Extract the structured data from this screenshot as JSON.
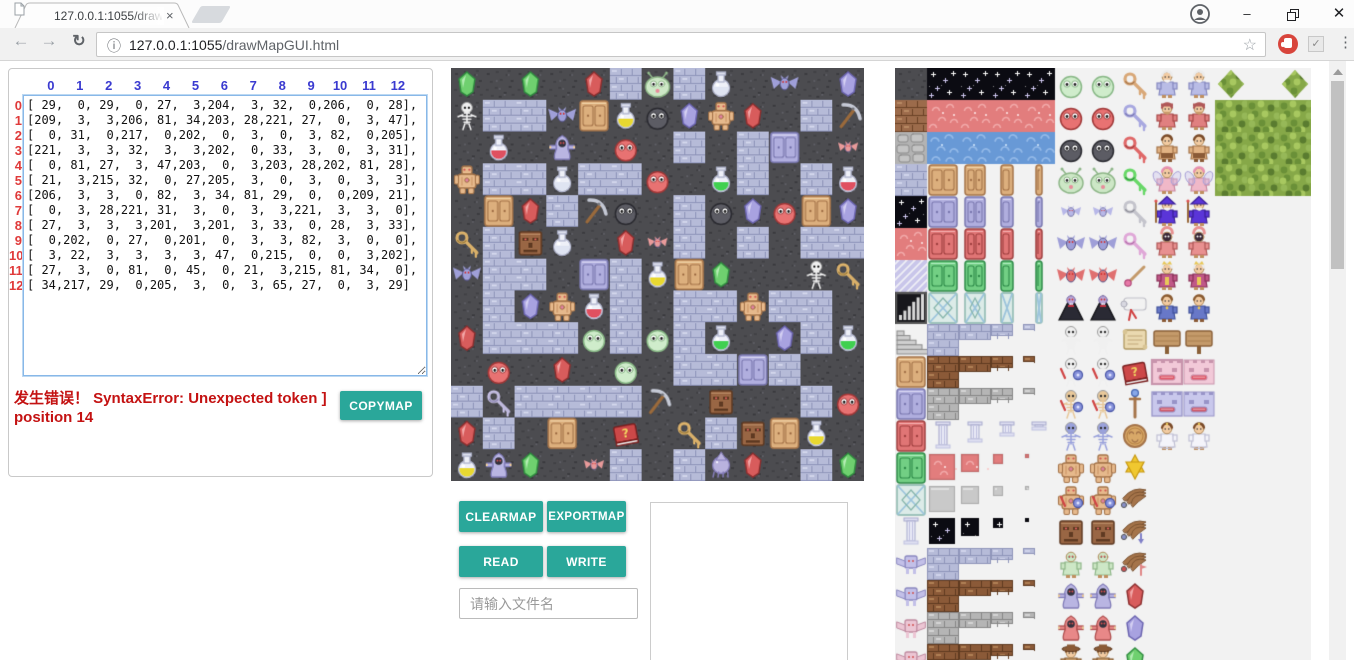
{
  "browser": {
    "tab_title": "127.0.0.1:1055/drawMa",
    "url_host": "127.0.0.1:1055",
    "url_path": "/drawMapGUI.html",
    "icons": {
      "back": "←",
      "forward": "→",
      "reload": "↻",
      "page_info": "ⓘ",
      "bookmark_star": "☆",
      "menu_dots": "⋮",
      "tab_close": "×",
      "window_minimize": "–",
      "window_close": "✕",
      "extension_check": "✓"
    }
  },
  "matrix_panel": {
    "col_headers": [
      "0",
      "1",
      "2",
      "3",
      "4",
      "5",
      "6",
      "7",
      "8",
      "9",
      "10",
      "11",
      "12"
    ],
    "row_headers": [
      "0",
      "1",
      "2",
      "3",
      "4",
      "5",
      "6",
      "7",
      "8",
      "9",
      "10",
      "11",
      "12"
    ],
    "rows": [
      [
        29,
        0,
        29,
        0,
        27,
        3,
        204,
        3,
        32,
        0,
        206,
        0,
        28
      ],
      [
        209,
        3,
        3,
        206,
        81,
        34,
        203,
        28,
        221,
        27,
        0,
        3,
        47
      ],
      [
        0,
        31,
        0,
        217,
        0,
        202,
        0,
        3,
        0,
        3,
        82,
        0,
        205
      ],
      [
        221,
        3,
        3,
        32,
        3,
        3,
        202,
        0,
        33,
        3,
        0,
        3,
        31
      ],
      [
        0,
        81,
        27,
        3,
        47,
        203,
        0,
        3,
        203,
        28,
        202,
        81,
        28
      ],
      [
        21,
        3,
        215,
        32,
        0,
        27,
        205,
        3,
        0,
        3,
        0,
        3,
        3
      ],
      [
        206,
        3,
        3,
        0,
        82,
        3,
        34,
        81,
        29,
        0,
        0,
        209,
        21
      ],
      [
        0,
        3,
        28,
        221,
        31,
        3,
        0,
        3,
        3,
        221,
        3,
        3,
        0
      ],
      [
        27,
        3,
        3,
        3,
        201,
        3,
        201,
        3,
        33,
        0,
        28,
        3,
        33
      ],
      [
        0,
        202,
        0,
        27,
        0,
        201,
        0,
        3,
        3,
        82,
        3,
        0,
        0
      ],
      [
        3,
        22,
        3,
        3,
        3,
        3,
        47,
        0,
        215,
        0,
        0,
        3,
        202
      ],
      [
        27,
        3,
        0,
        81,
        0,
        45,
        0,
        21,
        3,
        215,
        81,
        34,
        0
      ],
      [
        34,
        217,
        29,
        0,
        205,
        3,
        0,
        3,
        65,
        27,
        0,
        3,
        29
      ]
    ],
    "error": {
      "line1": "发生错误！ SyntaxError: Unexpected token ]",
      "line2": "position 14"
    },
    "copymap_label": "COPYMAP"
  },
  "map_editor": {
    "grid_size": "13x13",
    "tile_legend": {
      "0": "dark-stone-floor",
      "3": "blue-brick-floor",
      "21": "gold-key",
      "22": "silver-key",
      "27": "red-gem",
      "28": "purple-gem",
      "29": "green-gem",
      "31": "red-potion",
      "32": "empty-flask",
      "33": "green-potion",
      "34": "yellow-potion",
      "45": "question-book",
      "47": "pickaxe",
      "65": "purple-squid",
      "81": "tan-door",
      "82": "purple-door",
      "201": "pale-green-blob",
      "202": "red-blob",
      "203": "dark-blob",
      "204": "antenna-slime",
      "205": "pink-bat",
      "206": "purple-bat",
      "209": "skeleton",
      "215": "stone-face",
      "217": "ghost",
      "221": "golem"
    }
  },
  "controls": {
    "clearmap_label": "CLEARMAP",
    "exportmap_label": "EXPORTMAP",
    "read_label": "READ",
    "write_label": "WRITE",
    "filename_placeholder": "请输入文件名",
    "output_value": ""
  },
  "tileset_panel": {
    "legend": {
      "ds": "dark-stone-tile",
      "bb": "brown-brick-tile",
      "gs": "gray-stone-tile",
      "bl": "blue-brick-tile",
      "sf": "night-sky-tile",
      "rg": "red-ground-tile",
      "wt": "water-tile",
      "dg": "diagonal-stripes-tile",
      "br": "bar-graph-tile",
      "st": "stairs-tile",
      "td": "tan-door",
      "pd": "purple-door",
      "rd": "red-door",
      "gd": "green-door",
      "lt": "lattice-tile",
      "cm": "column-tile",
      "pt": "purple-altar",
      "kt": "pink-altar",
      "lB": "blue-brick-ledge",
      "lN": "dirt-ledge",
      "lG": "stone-ledge",
      "pR": "red-ground-piece",
      "pG": "stone-piece",
      "pS": "night-sky-piece",
      "mg": "green-blob-monster",
      "mr": "red-blob-monster",
      "mk": "dark-blob-monster",
      "ms": "antenna-slime",
      "b1": "pink-bat",
      "b2": "purple-bat",
      "b3": "red-bat",
      "vp": "vampire",
      "sk": "skeleton",
      "s2": "skeleton-with-shield",
      "s3": "tan-skeleton-with-shield",
      "s4": "armored-skeleton",
      "gl": "golem",
      "g2": "golem-with-shield",
      "fc": "stone-face",
      "gm": "green-man",
      "gh": "blue-ghost",
      "gr": "red-ghost",
      "ht": "hatted-villager",
      "k1": "tan-key",
      "k2": "blue-key",
      "k3": "red-key",
      "k4": "green-key",
      "k5": "gray-key",
      "k6": "pink-key",
      "wd": "wand",
      "sc": "scroll",
      "pc": "parchment",
      "bk": "question-book",
      "s5": "staff",
      "md": "medallion",
      "s6": "star",
      "wg": "wing",
      "wa": "wing-with-arrow",
      "wf": "wing-with-flag",
      "j1": "red-gem",
      "j2": "purple-gem",
      "j3": "green-gem",
      "el": "elder",
      "dw": "dwarf",
      "ba": "barbarian",
      "fy": "fairy",
      "wz": "wizard",
      "pr": "hooded-priest",
      "kg": "king",
      "pn": "prince",
      "sg": "wooden-sign",
      "w1": "pink-face-wall",
      "w2": "purple-face-wall",
      "ps": "princess",
      "tr": "tree-foliage",
      "bs": "bush",
      "..": "empty"
    },
    "grid": [
      [
        "ds",
        "sf",
        "sf",
        "sf",
        "sf",
        "mg",
        "mg",
        "k1",
        "el",
        "el",
        "bs",
        "..",
        "bs"
      ],
      [
        "bb",
        "rg",
        "rg",
        "rg",
        "rg",
        "mr",
        "mr",
        "k2",
        "dw",
        "dw",
        "tr",
        "tr",
        "tr"
      ],
      [
        "gs",
        "wt",
        "wt",
        "wt",
        "wt",
        "mk",
        "mk",
        "k3",
        "ba",
        "ba",
        "tr",
        "tr",
        "tr"
      ],
      [
        "bl",
        "td.3",
        "td.2",
        "td.1",
        "td.0",
        "ms",
        "ms",
        "k4",
        "fy",
        "fy",
        "tr",
        "tr",
        "tr"
      ],
      [
        "sf",
        "pd.3",
        "pd.2",
        "pd.1",
        "pd.0",
        "b1",
        "b1",
        "k5",
        "wz",
        "wz",
        "..",
        "..",
        ".."
      ],
      [
        "rg",
        "rd.3",
        "rd.2",
        "rd.1",
        "rd.0",
        "b2",
        "b2",
        "k6",
        "pr",
        "pr",
        "..",
        "..",
        ".."
      ],
      [
        "dg",
        "gd.3",
        "gd.2",
        "gd.1",
        "gd.0",
        "b3",
        "b3",
        "wd",
        "kg",
        "kg",
        "..",
        "..",
        ".."
      ],
      [
        "br",
        "lt.3",
        "lt.2",
        "lt.1",
        "lt.0",
        "vp",
        "vp",
        "sc",
        "pn",
        "pn",
        "..",
        "..",
        ".."
      ],
      [
        "st",
        "lB.3",
        "lB.2",
        "lB.1",
        "lB.0",
        "sk",
        "sk",
        "pc",
        "sg",
        "sg",
        "..",
        "..",
        ".."
      ],
      [
        "td",
        "lN.3",
        "lN.2",
        "lN.1",
        "lN.0",
        "s2",
        "s2",
        "bk",
        "w1",
        "w1",
        "..",
        "..",
        ".."
      ],
      [
        "pd",
        "lG.3",
        "lG.2",
        "lG.1",
        "lG.0",
        "s3",
        "s3",
        "s5",
        "w2",
        "w2",
        "..",
        "..",
        ".."
      ],
      [
        "rd",
        "cm.3",
        "cm.2",
        "cm.1",
        "cm.0",
        "s4",
        "s4",
        "md",
        "ps",
        "ps",
        "..",
        "..",
        ".."
      ],
      [
        "gd",
        "pR.3",
        "pR.2",
        "pR.1",
        "pR.0",
        "gl",
        "gl",
        "s6",
        "..",
        "..",
        "..",
        "..",
        ".."
      ],
      [
        "lt",
        "pG.3",
        "pG.2",
        "pG.1",
        "pG.0",
        "g2",
        "g2",
        "wg",
        "..",
        "..",
        "..",
        "..",
        ".."
      ],
      [
        "cm",
        "pS.3",
        "pS.2",
        "pS.1",
        "pS.0",
        "fc",
        "fc",
        "wa",
        "..",
        "..",
        "..",
        "..",
        ".."
      ],
      [
        "pt",
        "lB.3",
        "lB.2",
        "lB.1",
        "lB.0",
        "gm",
        "gm",
        "wf",
        "..",
        "..",
        "..",
        "..",
        ".."
      ],
      [
        "pt",
        "lN.3",
        "lN.2",
        "lN.1",
        "lN.0",
        "gh",
        "gh",
        "j1",
        "..",
        "..",
        "..",
        "..",
        ".."
      ],
      [
        "kt",
        "lG.3",
        "lG.2",
        "lG.1",
        "lG.0",
        "gr",
        "gr",
        "j2",
        "..",
        "..",
        "..",
        "..",
        ".."
      ],
      [
        "kt",
        "lN.3",
        "lN.2",
        "lN.1",
        "lN.0",
        "ht",
        "ht",
        "j3",
        "..",
        "..",
        "..",
        "..",
        ".."
      ]
    ]
  },
  "colors": {
    "accent_teal": "#2aa79a",
    "error_red": "#c41212",
    "col_header_blue": "#3a3ad0",
    "row_header_red": "#e03a3a",
    "toolbar_gray": "#f1f1f1",
    "map_dark": "#4c4c50",
    "map_brick": "#b6bbd8"
  }
}
